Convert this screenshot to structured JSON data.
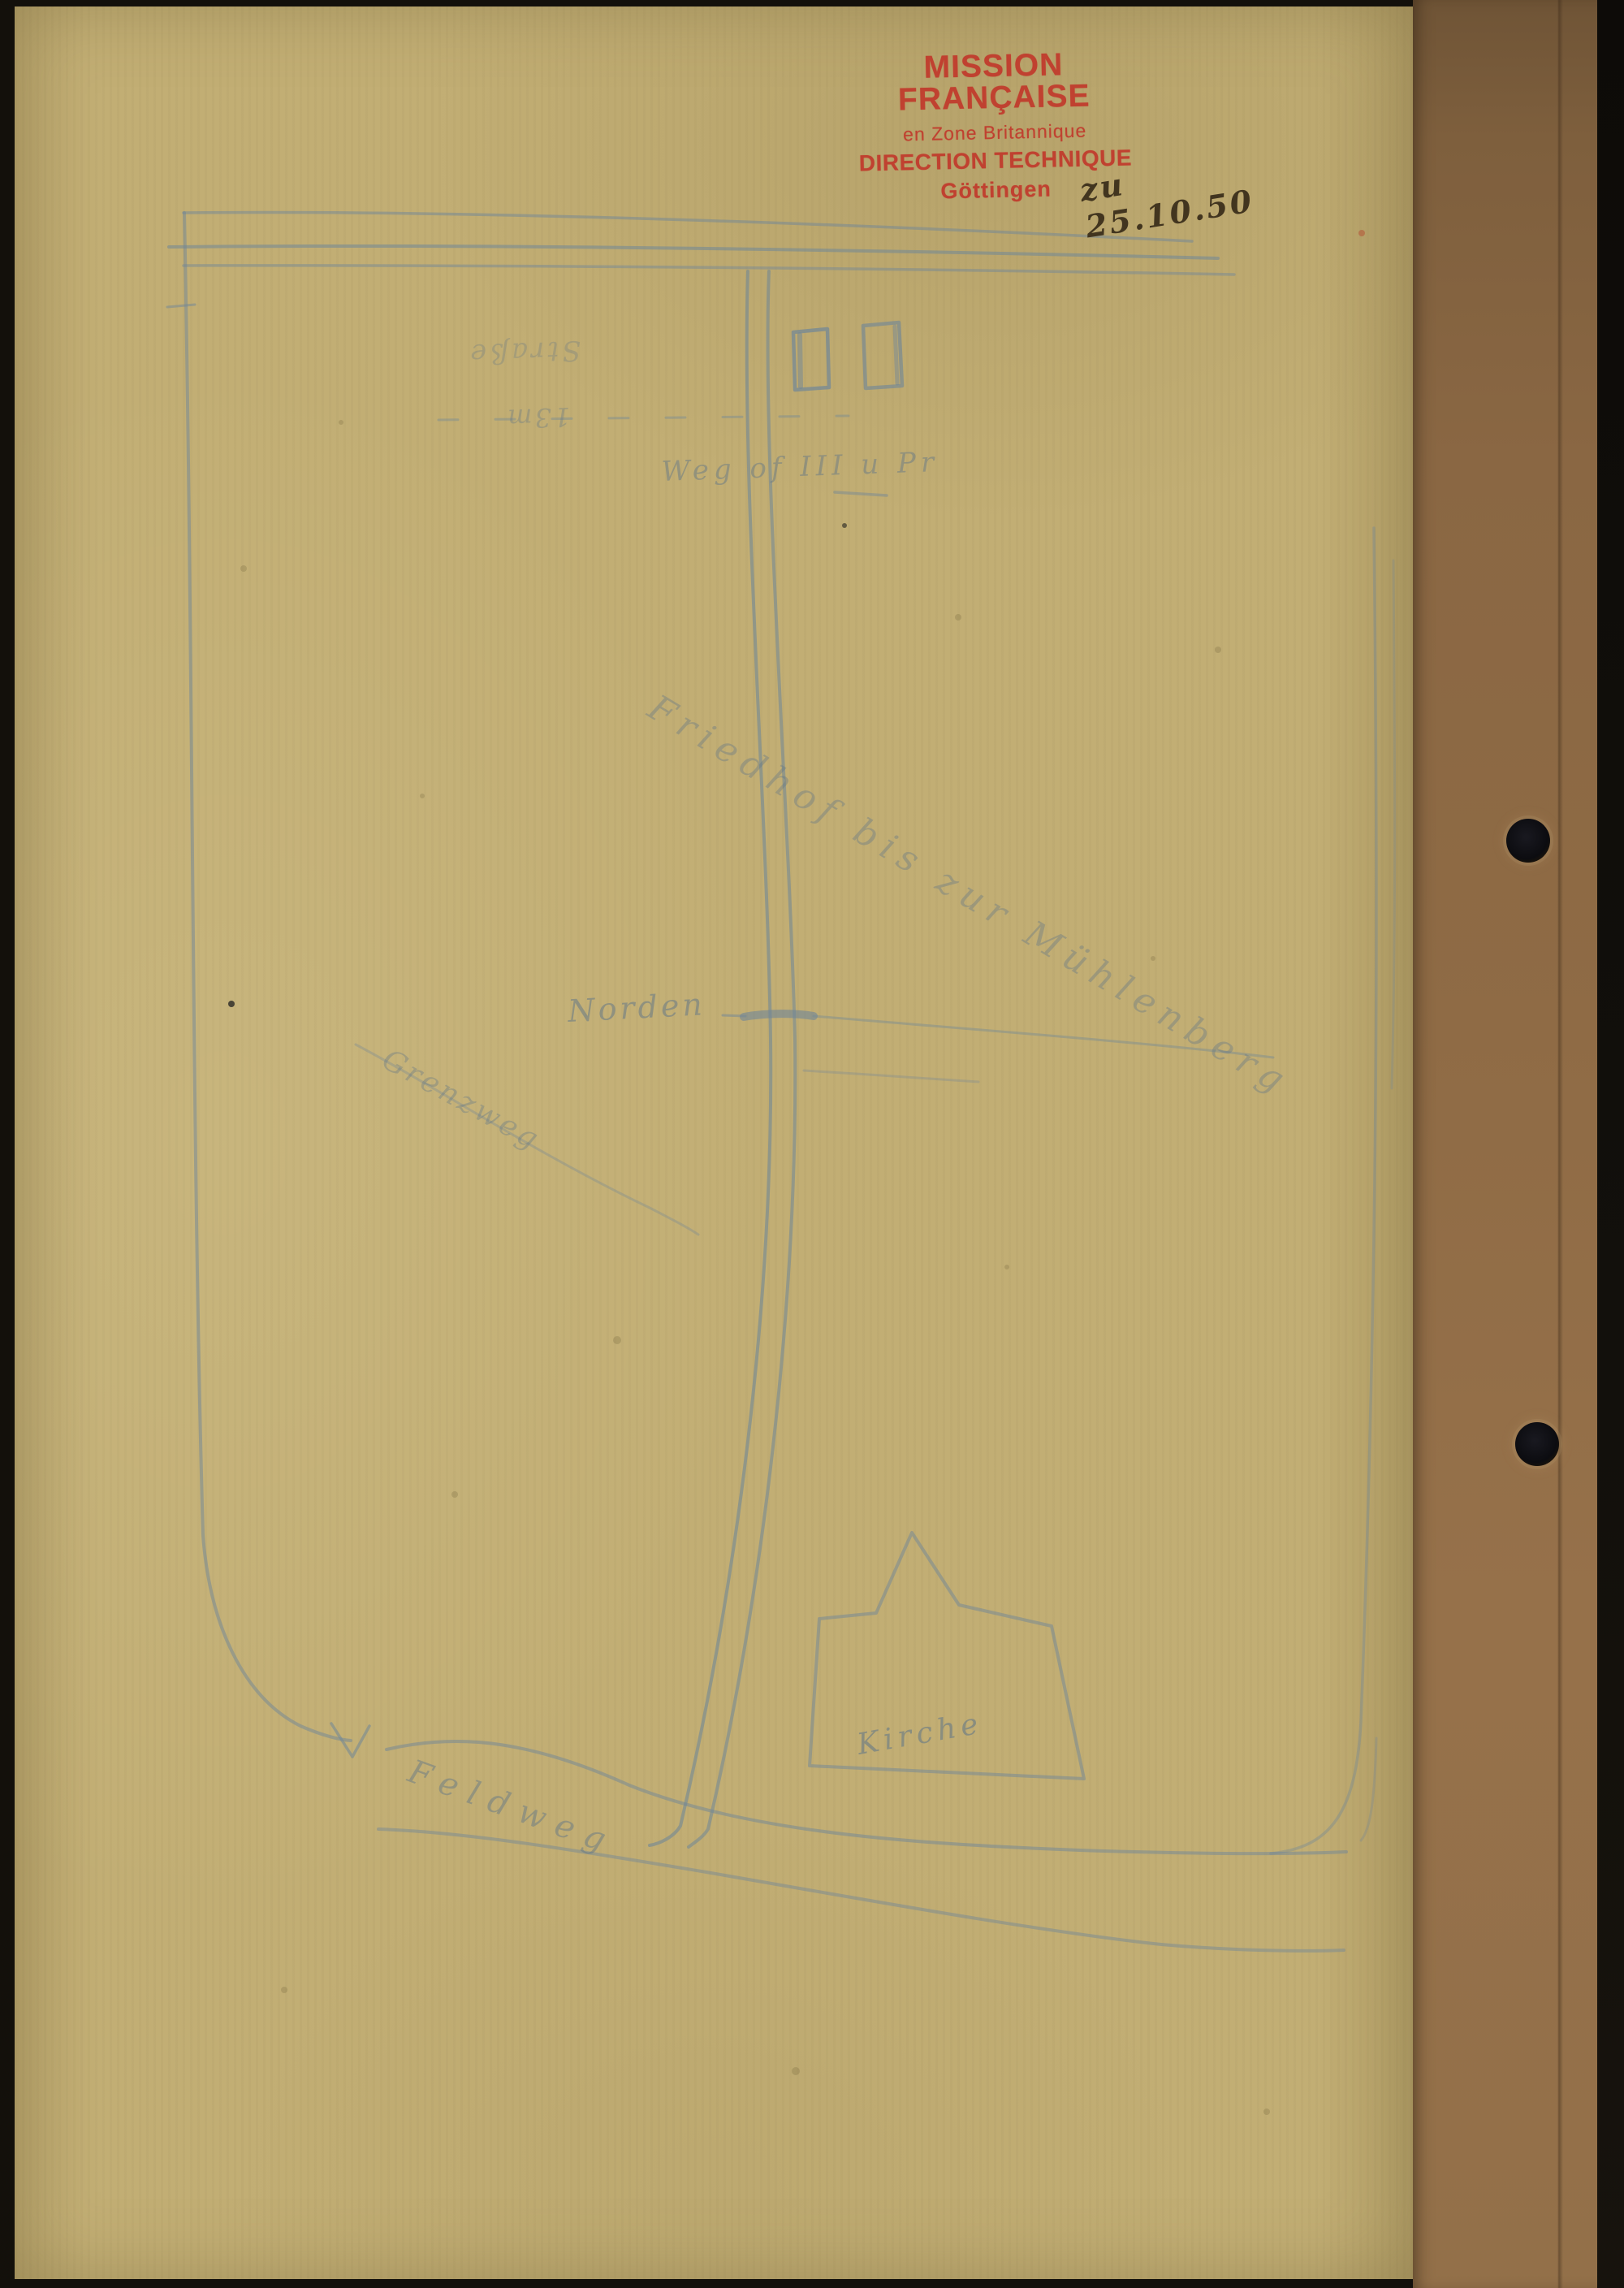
{
  "stamp": {
    "line1": "MISSION FRANÇAISE",
    "line2": "en Zone Britannique",
    "line3": "DIRECTION TECHNIQUE",
    "line4": "Göttingen",
    "ink_color": "#c13a2c"
  },
  "handwriting": {
    "date_note": "zu 25.10.50",
    "ink_color": "#42351f"
  },
  "sketch": {
    "pencil_color": "#6f8698",
    "labels": {
      "street_top": "Straße",
      "street_width": "13m",
      "annotation_top": "Weg of III u Pr",
      "diagonal_road_name": "Friedhof bis zur Mühlenberg",
      "direction": "Norden",
      "hill_name": "Grenzweg",
      "bottom_road_name": "Feldweg",
      "church": "Kirche"
    }
  },
  "materials": {
    "paper_color": "#c2ae74",
    "cardboard_color": "#8f6b45",
    "punch_hole_count": 2
  }
}
